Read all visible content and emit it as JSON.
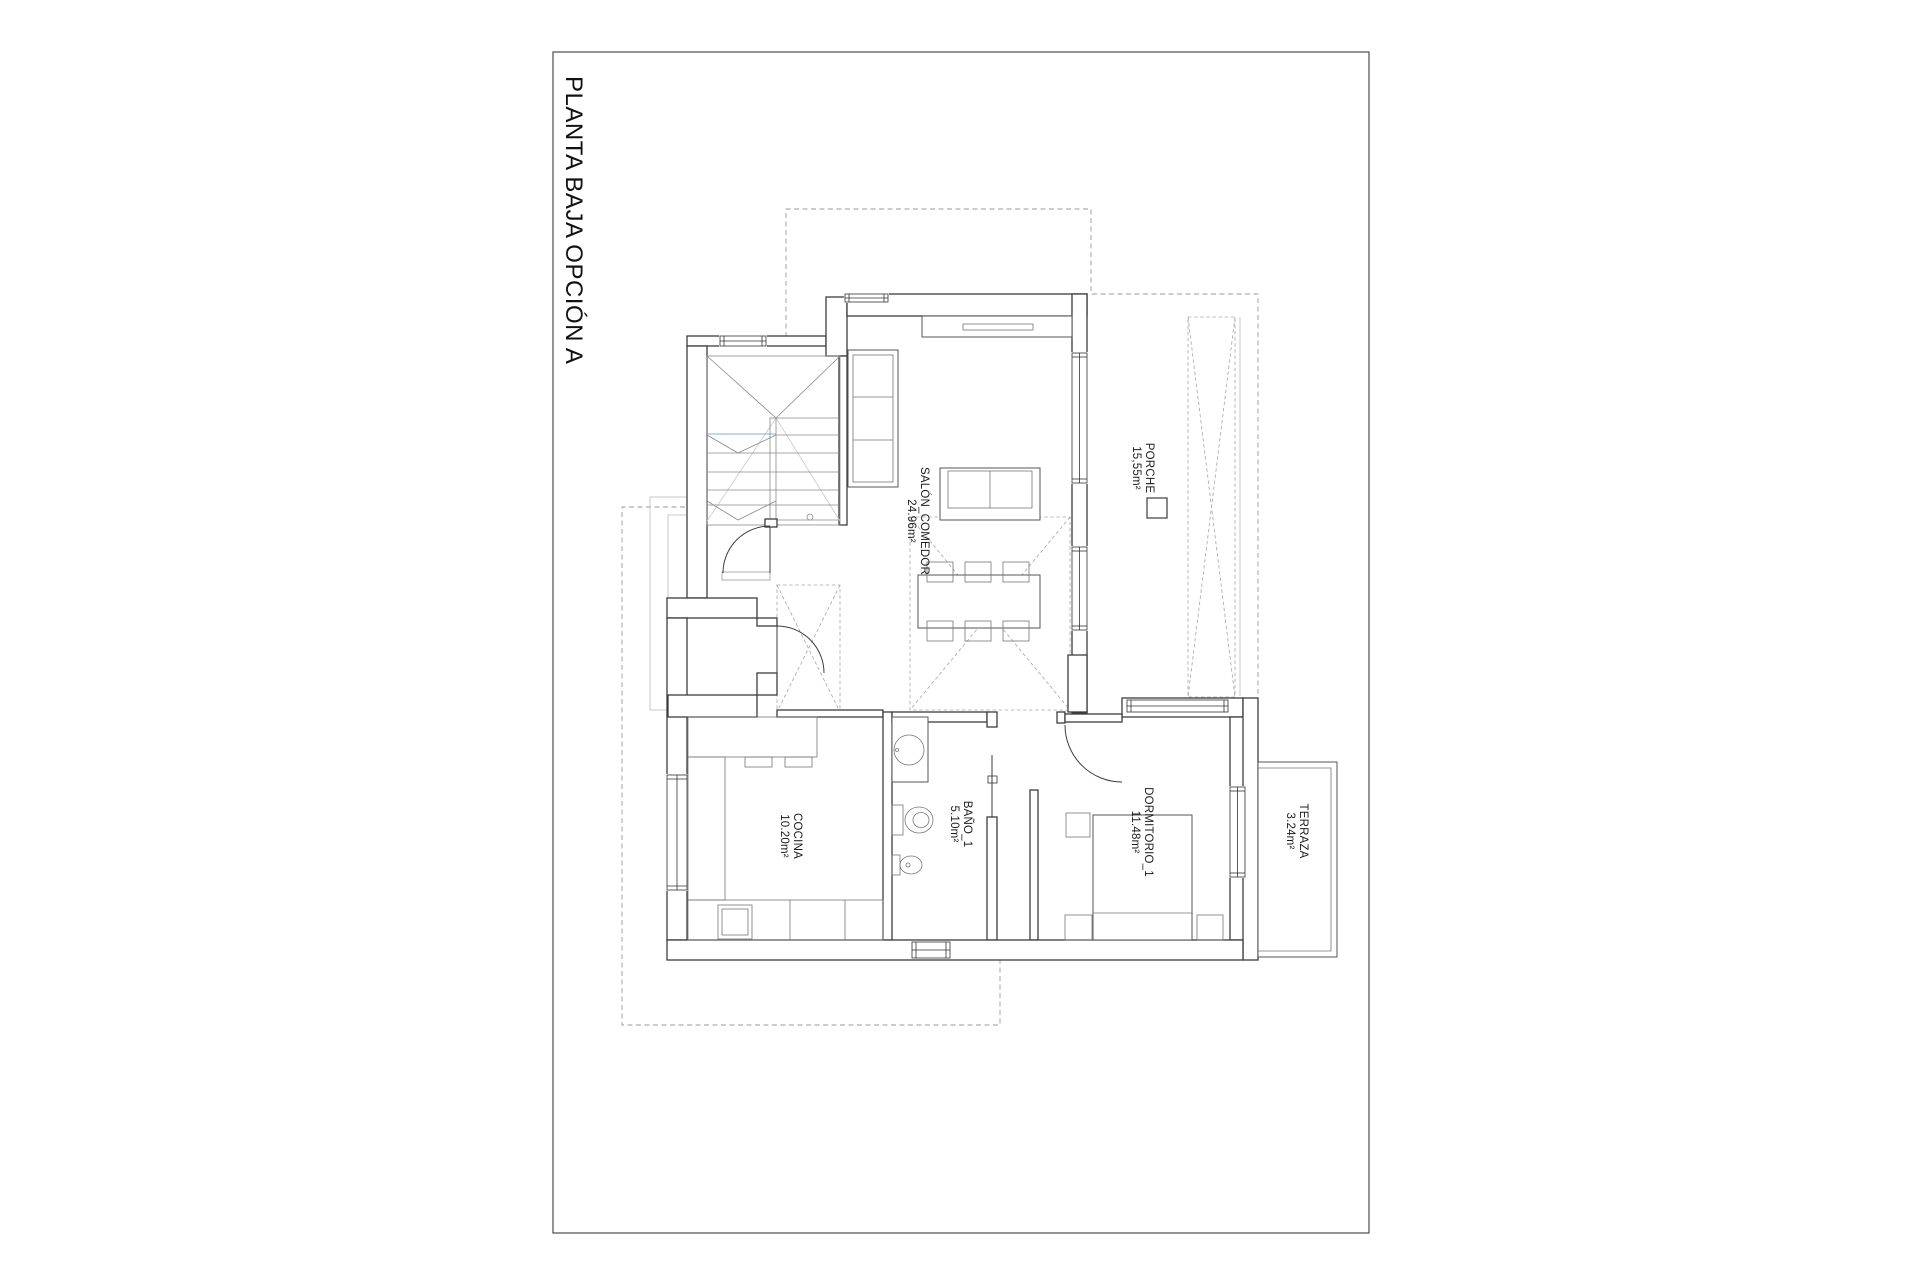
{
  "title": "PLANTA BAJA OPCIÓN A",
  "rooms": {
    "salon_comedor": {
      "name": "SALÓN_COMEDOR",
      "area": "24.96m²"
    },
    "porche": {
      "name": "PORCHE",
      "area": "15,55m²"
    },
    "cocina": {
      "name": "COCINA",
      "area": "10.20m²"
    },
    "bano_1": {
      "name": "BAÑO_1",
      "area": "5.10m²"
    },
    "dormitorio_1": {
      "name": "DORMITORIO_1",
      "area": "11.48m²"
    },
    "terraza": {
      "name": "TERRAZA",
      "area": "3.24m²"
    }
  },
  "colors": {
    "paper": "#ffffff",
    "line": "#3d3d3d",
    "line_light": "#8a8a8a",
    "dashed": "#9a9a9a",
    "accent_blue": "#7fb2d9"
  }
}
